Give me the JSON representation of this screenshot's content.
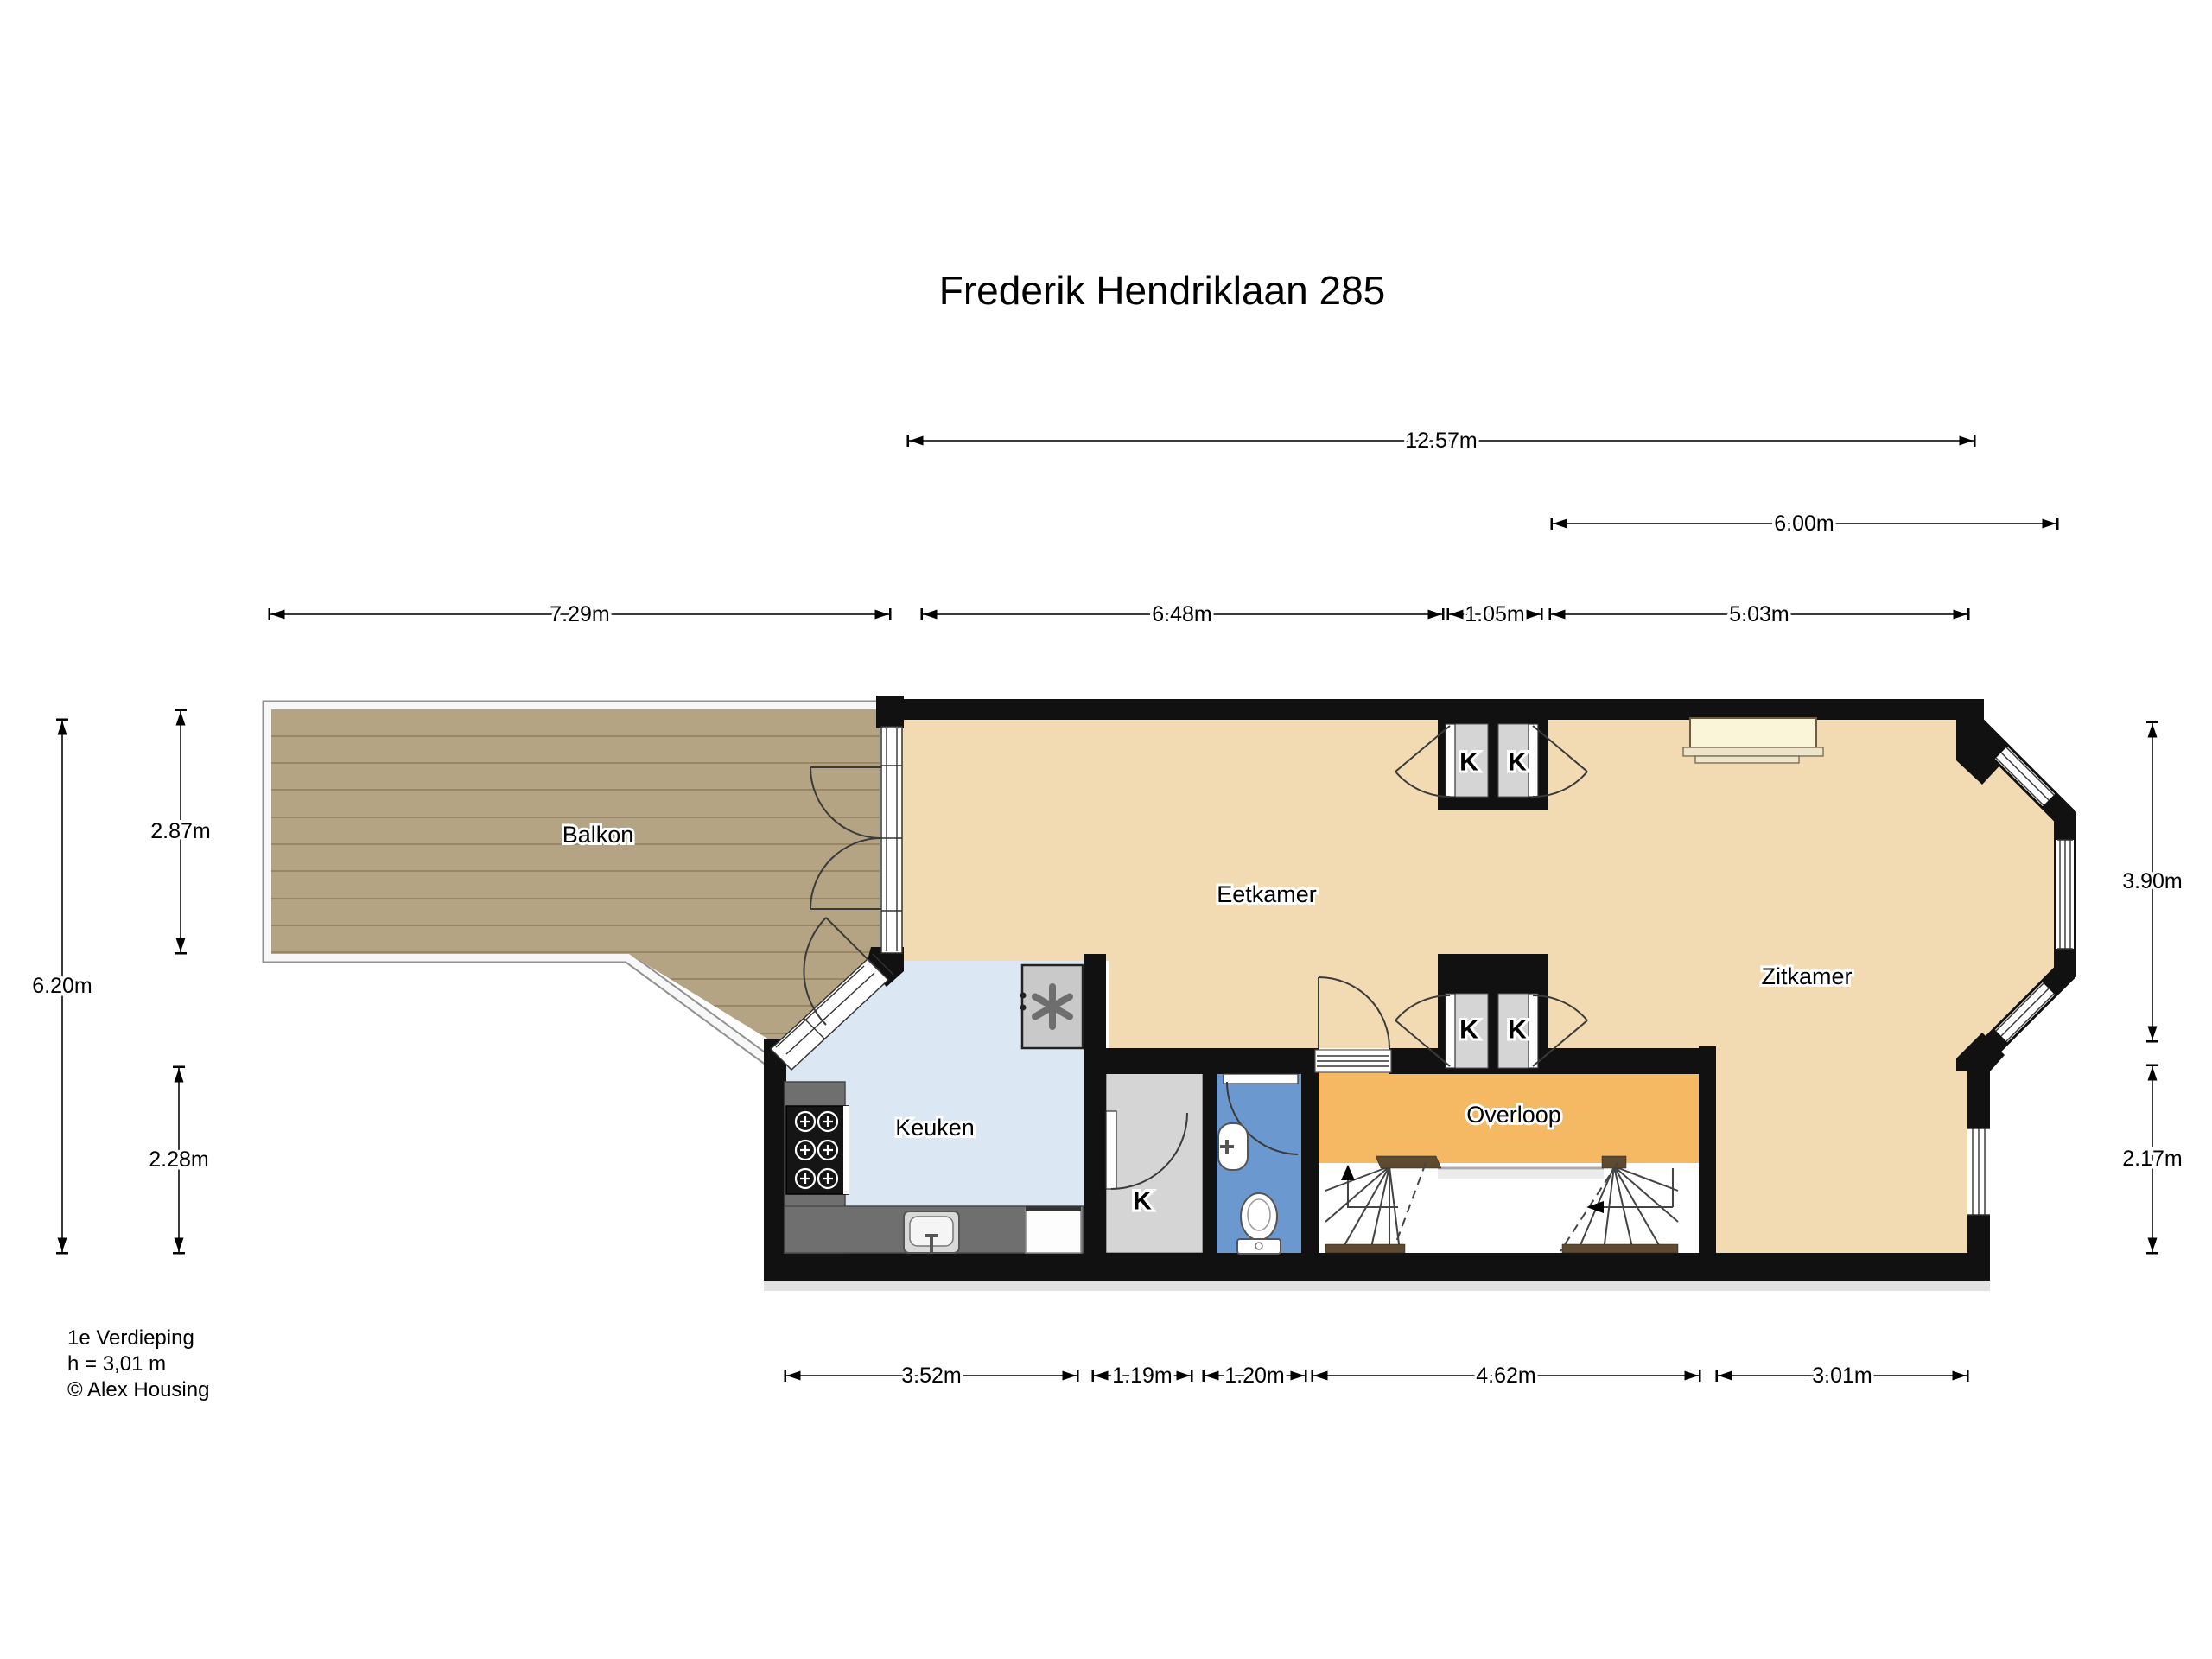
{
  "title": "Frederik Hendriklaan 285",
  "rooms": {
    "balkon": "Balkon",
    "eetkamer": "Eetkamer",
    "zitkamer": "Zitkamer",
    "keuken": "Keuken",
    "overloop": "Overloop",
    "closet_label": "K"
  },
  "dims": {
    "d_top": "12.57m",
    "d_600": "6.00m",
    "d_729": "7.29m",
    "d_648": "6.48m",
    "d_105": "1.05m",
    "d_503": "5.03m",
    "d_620": "6.20m",
    "d_287": "2.87m",
    "d_228": "2.28m",
    "d_390": "3.90m",
    "d_217": "2.17m",
    "d_352": "3.52m",
    "d_119": "1.19m",
    "d_120": "1.20m",
    "d_462": "4.62m",
    "d_301": "3.01m"
  },
  "footer": {
    "line1": "1e Verdieping",
    "line2": "h = 3,01 m",
    "line3": "© Alex Housing"
  },
  "colors": {
    "wall": "#111111",
    "floor_living": "#f2dbb2",
    "floor_kitchen": "#dbe7f3",
    "floor_landing": "#f5b863",
    "toilet": "#6b99cf",
    "closet": "#d5d5d5",
    "balcony_wood": "#b5a483",
    "window_sill": "#faf5d8",
    "counter": "#6f6f6f"
  }
}
